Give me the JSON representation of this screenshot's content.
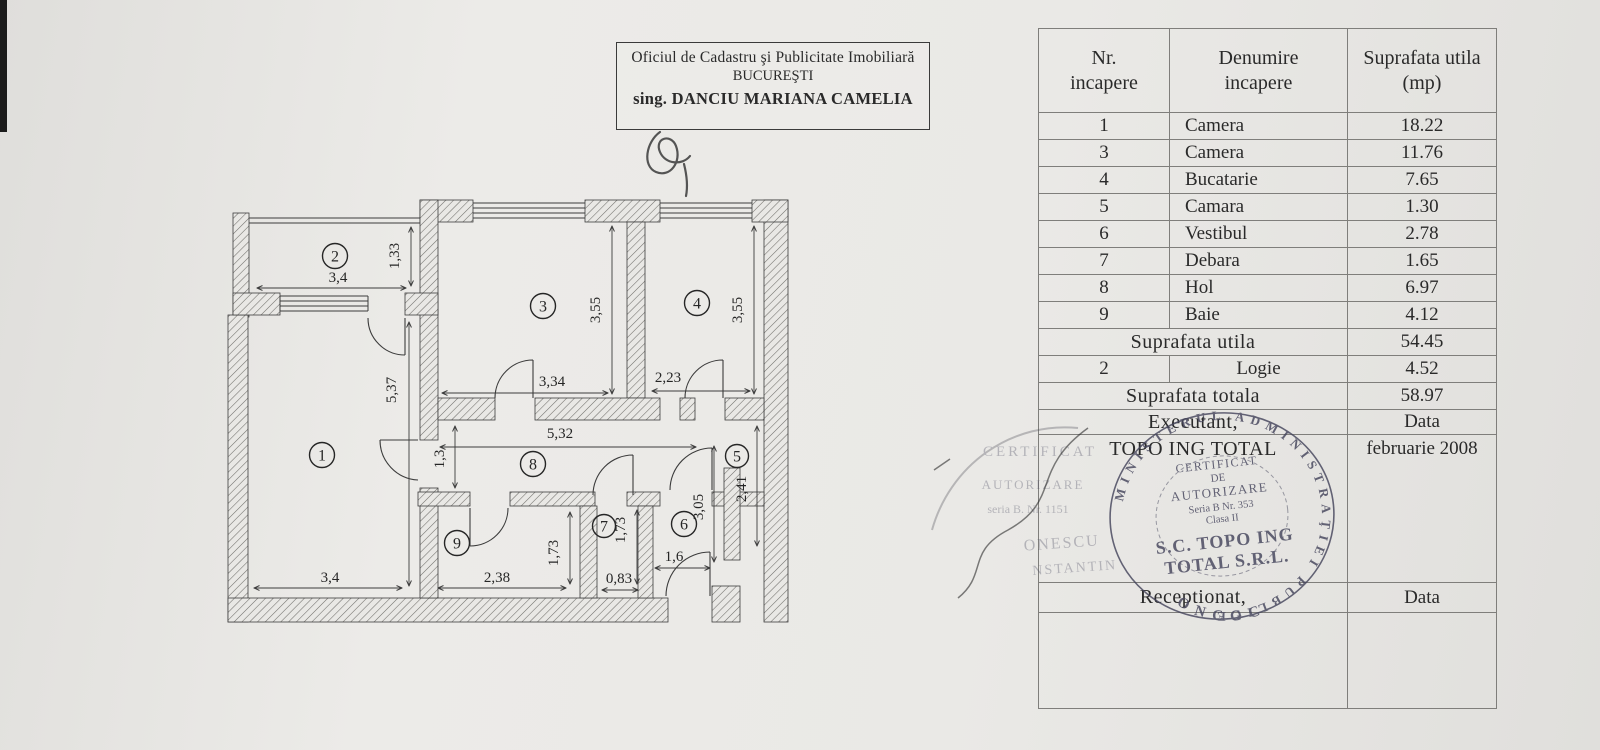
{
  "header_box": {
    "line1": "Oficiul de Cadastru şi Publicitate Imobiliară",
    "line2": "BUCUREŞTI",
    "line3": "sing. DANCIU MARIANA CAMELIA"
  },
  "table": {
    "headers": [
      {
        "l1": "Nr.",
        "l2": "incapere"
      },
      {
        "l1": "Denumire",
        "l2": "incapere"
      },
      {
        "l1": "Suprafata utila",
        "l2": "(mp)"
      }
    ],
    "rows": [
      {
        "nr": "1",
        "name": "Camera",
        "area": "18.22"
      },
      {
        "nr": "3",
        "name": "Camera",
        "area": "11.76"
      },
      {
        "nr": "4",
        "name": "Bucatarie",
        "area": "7.65"
      },
      {
        "nr": "5",
        "name": "Camara",
        "area": "1.30"
      },
      {
        "nr": "6",
        "name": "Vestibul",
        "area": "2.78"
      },
      {
        "nr": "7",
        "name": "Debara",
        "area": "1.65"
      },
      {
        "nr": "8",
        "name": "Hol",
        "area": "6.97"
      },
      {
        "nr": "9",
        "name": "Baie",
        "area": "4.12"
      }
    ],
    "summary_utila": {
      "label": "Suprafata utila",
      "value": "54.45"
    },
    "logie_row": {
      "nr": "2",
      "name": "Logie",
      "area": "4.52"
    },
    "summary_totala": {
      "label": "Suprafata totala",
      "value": "58.97"
    },
    "executant_row": {
      "label": "Executant,",
      "value": "Data"
    },
    "company_row": {
      "label": "TOPO ING TOTAL",
      "value": "februarie 2008"
    },
    "receptionat_row": {
      "label": "Receptionat,",
      "value": "Data"
    }
  },
  "plan": {
    "room_numbers": [
      "1",
      "2",
      "3",
      "4",
      "5",
      "6",
      "7",
      "8",
      "9"
    ],
    "dims": {
      "logie_w": "3,4",
      "logie_h": "1,33",
      "room1_h": "5,37",
      "room1_w": "3,4",
      "room3_w": "3,34",
      "room3_h": "3,55",
      "room4_w": "2,23",
      "room4_h": "3,55",
      "hall_w": "5,32",
      "hall_h": "1,3",
      "room9_w": "2,38",
      "room9_h": "1,73",
      "room7_h": "1,73",
      "room7_w": "0,83",
      "room6_w": "1,6",
      "room6_h": "3,05",
      "room5_h": "2,41"
    }
  },
  "stamp": {
    "ring": "MINISTERUL ADMINISTRAŢIEI PUBLICE",
    "bottom": "ONCGC",
    "l1": "CERTIFICAT",
    "l2": "DE",
    "l3": "AUTORIZARE",
    "l4": "Seria B Nr. 353",
    "l5": "Clasa II",
    "l6": "S.C. TOPO ING",
    "l7": "TOTAL S.R.L."
  },
  "stamp_faint": {
    "l1": "CERTIFICAT",
    "l2": "AUTORIZARE",
    "l3": "seria B. Nr. 1151",
    "name1": "ONESCU",
    "name2": "NSTANTIN"
  }
}
